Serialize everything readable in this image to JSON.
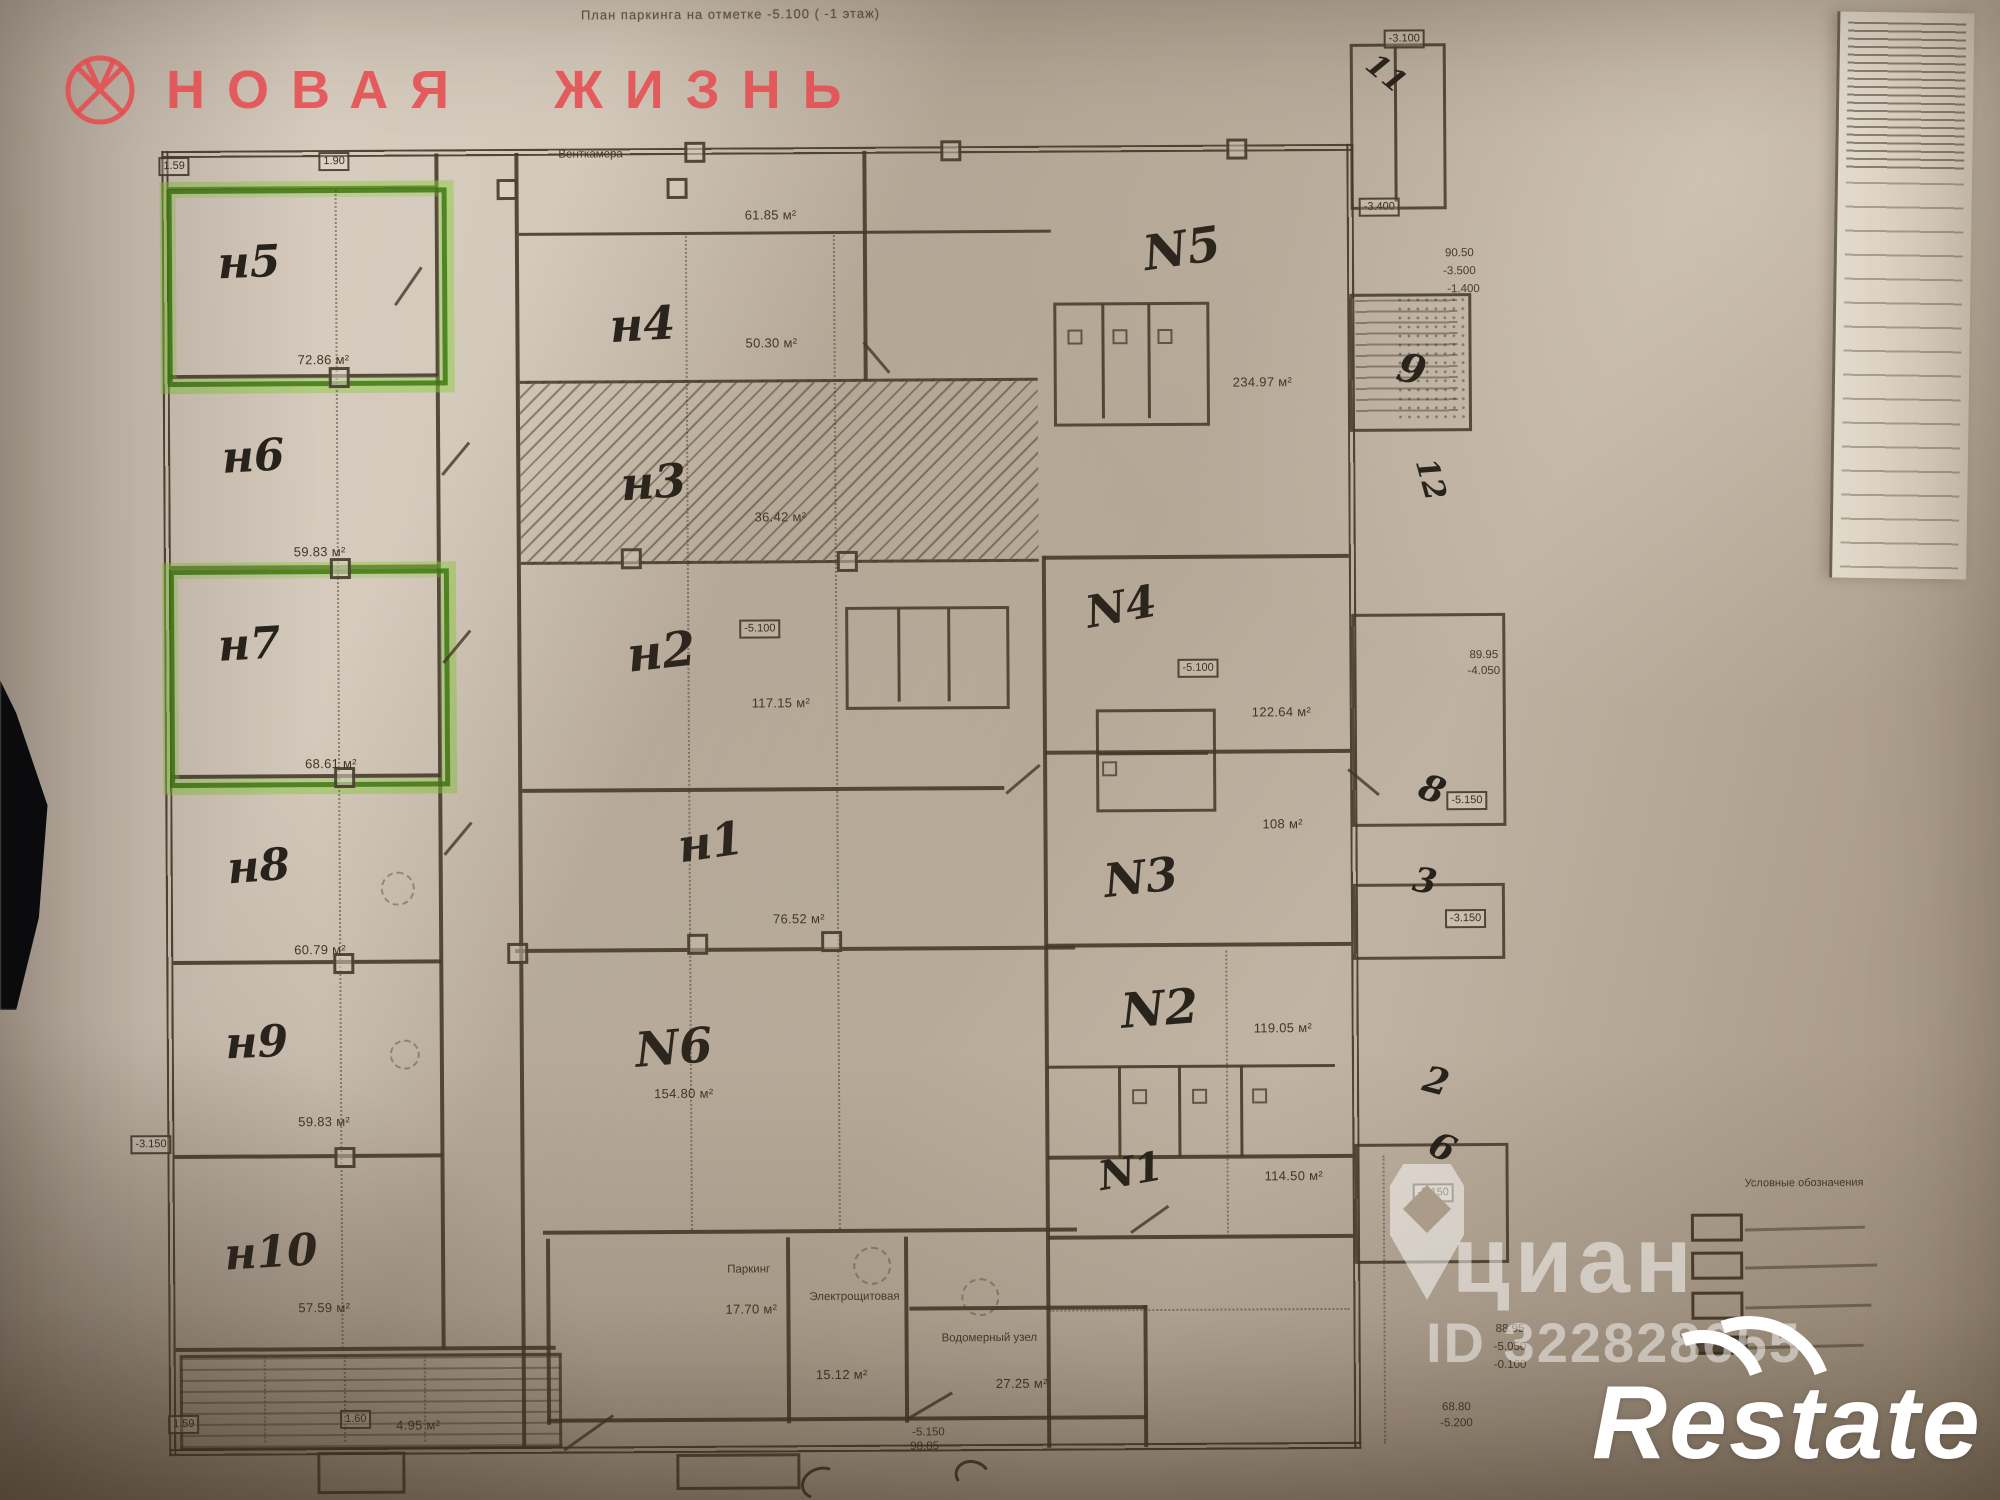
{
  "photo": {
    "title": "План паркинга на отметке -5.100 ( -1 этаж)"
  },
  "brand": {
    "logo_text": "НОВАЯ ЖИЗНЬ"
  },
  "plan": {
    "left_rooms": [
      {
        "id": "н5",
        "area": "72.86 м²"
      },
      {
        "id": "н6",
        "area": "59.83 м²"
      },
      {
        "id": "н7",
        "area": "68.61 м²"
      },
      {
        "id": "н8",
        "area": "60.79 м²"
      },
      {
        "id": "н9",
        "area": "59.83 м²"
      },
      {
        "id": "н10",
        "area": "57.59 м²"
      }
    ],
    "middle_rooms": [
      {
        "id": "н4",
        "area": "50.30 м²"
      },
      {
        "id": "н3",
        "area": "36.42 м²"
      },
      {
        "id": "н2",
        "area": "117.15 м²"
      },
      {
        "id": "н1",
        "area": "76.52 м²"
      },
      {
        "id": "N6",
        "area": "154.80 м²"
      }
    ],
    "right_rooms": [
      {
        "id": "N5",
        "area": "234.97 м²"
      },
      {
        "id": "N4",
        "area": "122.64 м²"
      },
      {
        "id": "N3",
        "area": "108 м²"
      },
      {
        "id": "N2",
        "area": "119.05 м²"
      },
      {
        "id": "N1",
        "area": "114.50 м²"
      }
    ],
    "service_rooms": [
      {
        "name": "Паркинг",
        "area": "17.70 м²"
      },
      {
        "name": "Электрощитовая",
        "area": "15.12 м²"
      },
      {
        "name": "Водомерный узел",
        "area": "27.25 м²"
      }
    ],
    "top_labels": {
      "ventkamera": "Венткамера",
      "corridor_area": "61.85 м²"
    },
    "stair_labels": {
      "area": "4.95 м²"
    },
    "dim_boxes": {
      "top_a": "1.59",
      "top_b": "1.90",
      "stair_a": "1.59",
      "stair_b": "1.60",
      "left": "-3.150"
    },
    "elevation_boxes": {
      "n2": "-5.100",
      "n4": "-5.100",
      "right_upper": "-3.400",
      "right_corner": "-3.100",
      "right_mid": "-5.150",
      "right_n3": "-3.150",
      "right_n1": "-5.150"
    },
    "elevation_stacks": {
      "top_right": [
        "90.50",
        "-3.500",
        "-1.400"
      ],
      "right_n4": [
        "89.95",
        "-4.050"
      ],
      "right_lower": [
        "88.95",
        "-5.050",
        "-0.100"
      ],
      "bottom_center": [
        "-5.150",
        "98.85"
      ],
      "bottom_right": [
        "68.80",
        "-5.200"
      ]
    },
    "shaft_numbers": [
      "11",
      "9",
      "12",
      "8",
      "3",
      "2",
      "6"
    ]
  },
  "watermarks": {
    "cian": "циан",
    "cian_id": "ID 322828655",
    "restate": "Restate"
  },
  "legend": {
    "title": "Условные обозначения"
  }
}
